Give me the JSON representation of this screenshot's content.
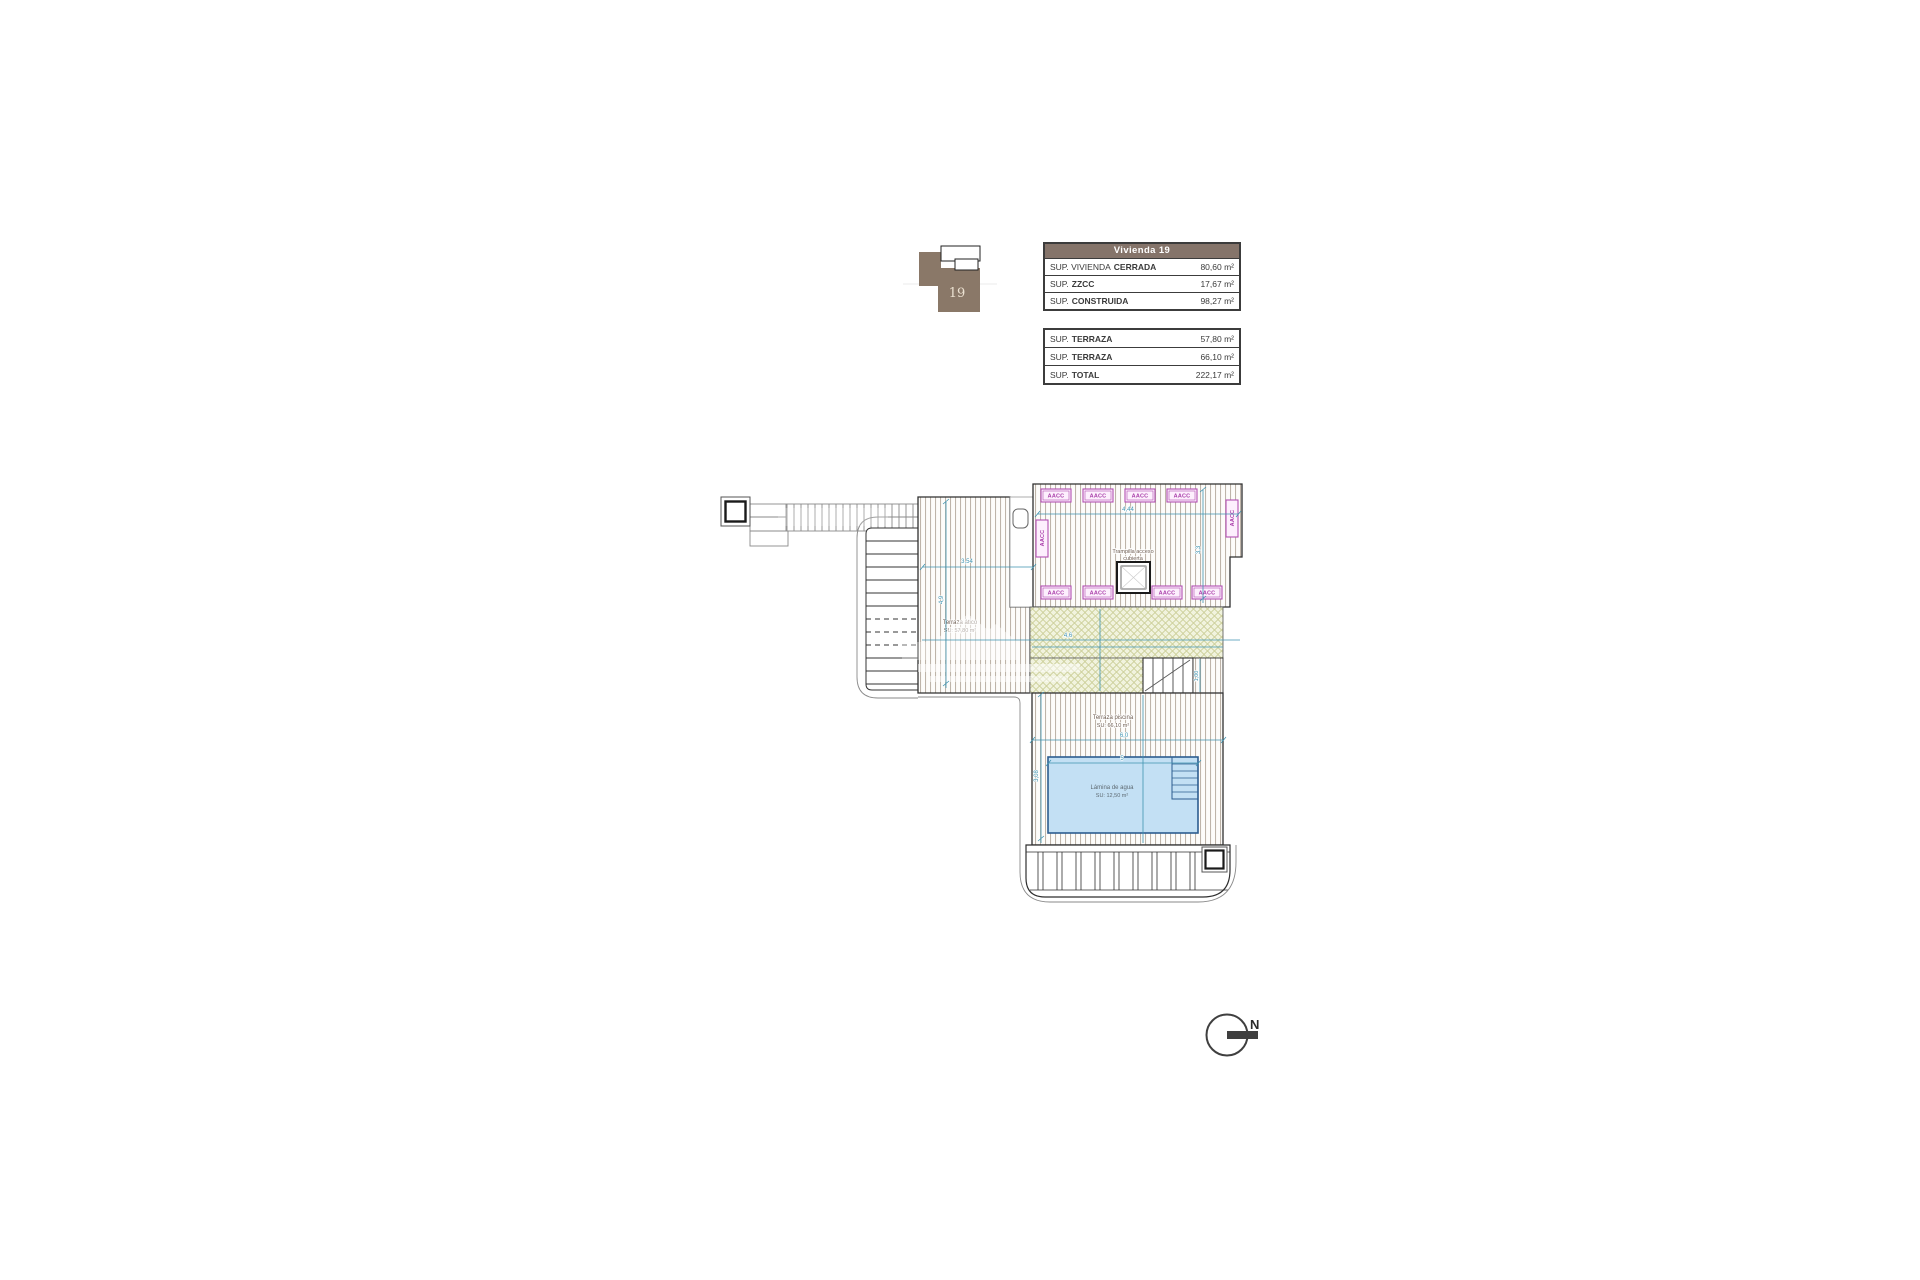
{
  "colors": {
    "table_header_bg": "#85746a",
    "key_plan_brown": "#8a7868",
    "aacc_magenta": "#a83ca8",
    "dimension_teal": "#3f93b0",
    "pool_fill": "#c3e0f4",
    "pool_border": "#2c5d8f",
    "green_hatch_bg": "#f1f3de",
    "green_hatch_line": "#c9cc93",
    "deck_hatch_line": "#b3a89b"
  },
  "key_plan": {
    "number": "19"
  },
  "area_table": {
    "header": "Vivienda 19",
    "rows": [
      {
        "prefix": "SUP. VIVIENDA",
        "name": "CERRADA",
        "value": "80,60 m²"
      },
      {
        "prefix": "SUP.",
        "name": "ZZCC",
        "value": "17,67 m²"
      },
      {
        "prefix": "SUP.",
        "name": "CONSTRUIDA",
        "value": "98,27 m²"
      }
    ]
  },
  "terrace_table": {
    "rows": [
      {
        "prefix": "SUP.",
        "name": "TERRAZA",
        "value": "57,80 m²"
      },
      {
        "prefix": "SUP.",
        "name": "TERRAZA",
        "value": "66,10 m²"
      },
      {
        "prefix": "SUP.",
        "name": "TOTAL",
        "value": "222,17 m²"
      }
    ]
  },
  "plan": {
    "aacc_label": "AACC",
    "trampilla_line1": "Trampilla acceso",
    "trampilla_line2": "cubierta",
    "terraza_atico_line1": "Terraza ático",
    "terraza_atico_line2": "SU: 57,80 m²",
    "terraza_piscina_line1": "Terraza piscina",
    "terraza_piscina_line2": "SU: 66,10 m²",
    "pool_line1": "Lámina de agua",
    "pool_line2": "SU: 12,50 m²",
    "dims": {
      "atico_w": "3,54",
      "atico_h": "4,9",
      "aacc_w": "4,44",
      "aacc_h": "3,3",
      "mid_w": "4,6",
      "piscina_w": "6,0",
      "pool_w": "5",
      "pool_h": "3,08",
      "stairs_h": "1,00"
    }
  },
  "compass": {
    "label": "N"
  }
}
